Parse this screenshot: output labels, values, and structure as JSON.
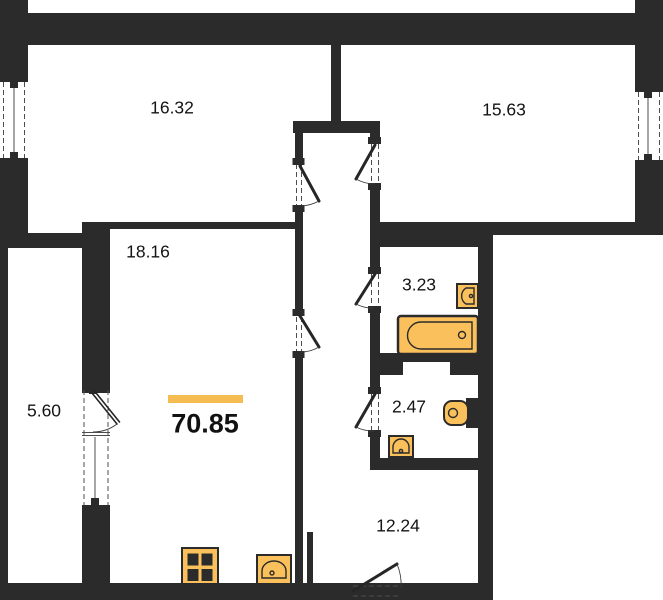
{
  "floor_plan": {
    "total_area": "70.85",
    "room_areas": {
      "top_left": "16.32",
      "top_right": "15.63",
      "living": "18.16",
      "bathroom": "3.23",
      "wc": "2.47",
      "balcony": "5.60",
      "hall": "12.24"
    },
    "colors": {
      "wall": "#2b2b2b",
      "fixture": "#FAC05C",
      "accent": "#F5BD51"
    },
    "fixtures": [
      "bathtub",
      "bathroom-sink",
      "toilet",
      "wc-sink",
      "stove",
      "kitchen-sink"
    ]
  }
}
